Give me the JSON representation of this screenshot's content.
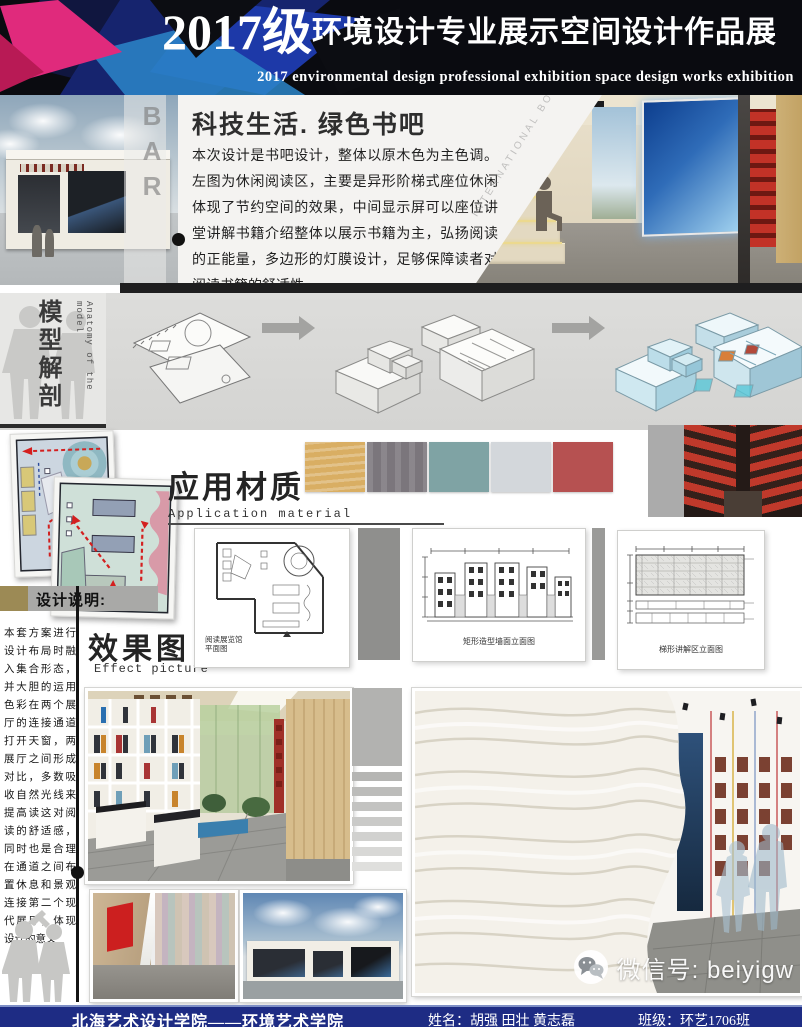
{
  "header": {
    "title_year": "2017级",
    "title_cn": "环境设计专业展示空间设计作品展",
    "subtitle_en": "2017 environmental design professional exhibition space design works exhibition"
  },
  "intro": {
    "book_bar_label": "BOOK BAR",
    "section_title": "科技生活. 绿色书吧",
    "paragraph": "本次设计是书吧设计，整体以原木色为主色调。左图为休闲阅读区，主要是异形阶梯式座位休闲体现了节约空间的效果，中间显示屏可以座位讲堂讲解书籍介绍整体以展示书籍为主，弘扬阅读的正能量，多边形的灯膜设计，足够保障读者对阅读书籍的舒适性。",
    "watermark": "INTERNATIONAL BOOK EXHIBITION"
  },
  "anatomy": {
    "label_cn": "模型解剖",
    "label_en": "Anatomy of the model"
  },
  "materials": {
    "title_cn": "应用材质",
    "title_en": "Application material",
    "swatches": [
      {
        "name": "wood",
        "color": "#d9ae63"
      },
      {
        "name": "concrete-gray",
        "color": "#7b767c"
      },
      {
        "name": "teal",
        "color": "#7fa3a4"
      },
      {
        "name": "light-gray",
        "color": "#d3d7db"
      },
      {
        "name": "brick-red",
        "color": "#b65151"
      }
    ]
  },
  "design_notes": {
    "title": "设计说明:",
    "paragraph": "本套方案进行设计布局时融入集合形态，并大胆的运用色彩在两个展厅的连接通道打开天窗，两展厅之间形成对比，多数吸收自然光线来提高读这对阅读的舒适感，同时也是合理在通道之间布置休息和景观连接第二个现代展厅，体现设计的意义"
  },
  "drawings": {
    "caption_plan_line1": "阅读展览馆",
    "caption_plan_line2": "平面图",
    "caption_wall": "矩形造型墙面立面图",
    "caption_stair": "梯形讲解区立面图"
  },
  "effects": {
    "title_cn": "效果图",
    "title_en": "Effect picture"
  },
  "wechat": {
    "label": "微信号: beiyigw"
  },
  "footer": {
    "school": "北海艺术设计学院——环境艺术学院",
    "names": "姓名：胡强 田壮 黄志磊",
    "class_name": "班级：环艺1706班"
  }
}
